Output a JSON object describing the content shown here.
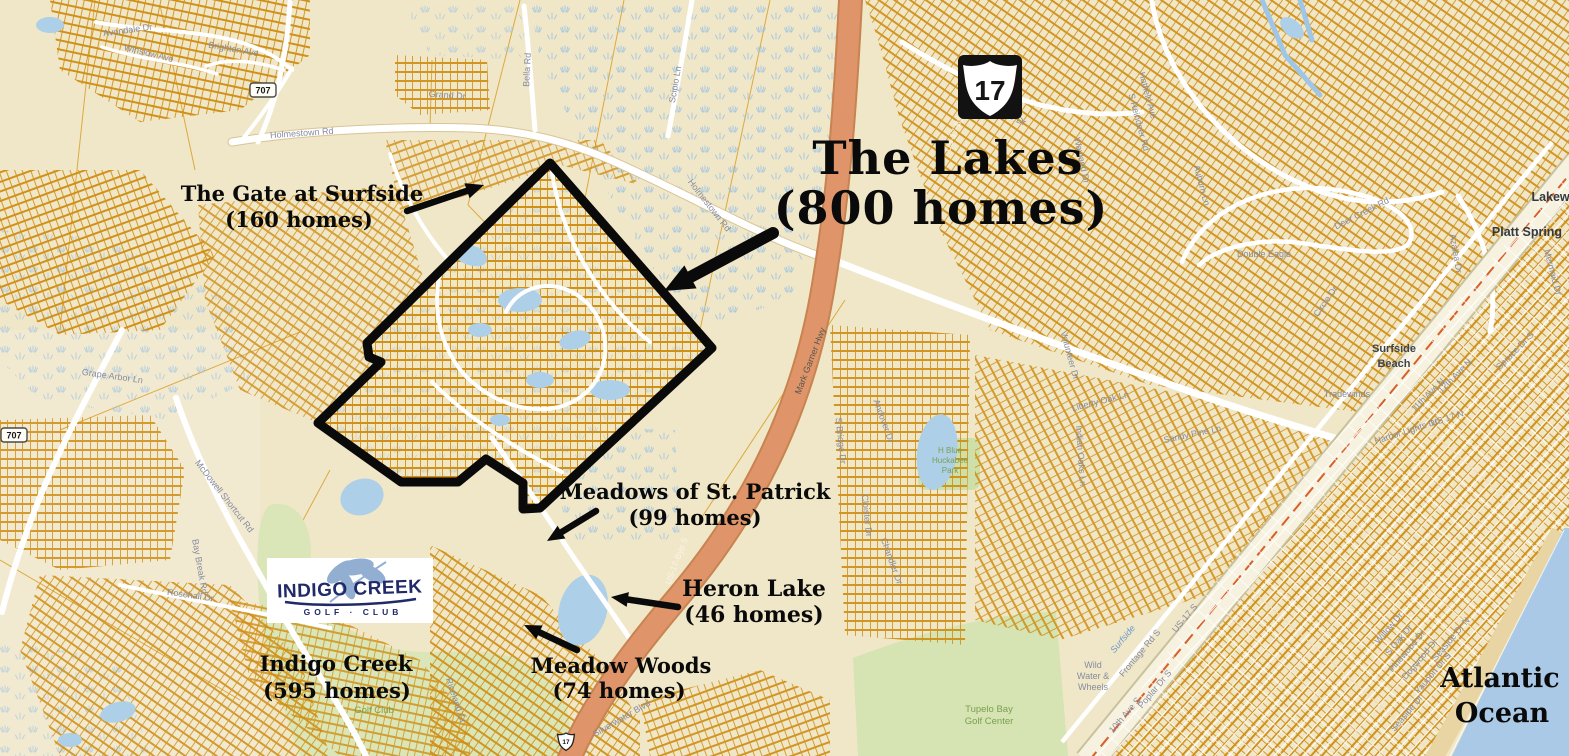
{
  "annotations": {
    "the_lakes": {
      "title": "The Lakes",
      "subtitle": "(800 homes)"
    },
    "gate": {
      "title": "The Gate at Surfside",
      "subtitle": "(160 homes)"
    },
    "meadows": {
      "title": "Meadows of St. Patrick",
      "subtitle": "(99 homes)"
    },
    "heron": {
      "title": "Heron Lake",
      "subtitle": "(46 homes)"
    },
    "meadow_woods": {
      "title": "Meadow Woods",
      "subtitle": "(74 homes)"
    },
    "indigo_creek": {
      "title": "Indigo Creek",
      "subtitle": "(595 homes)"
    },
    "ocean": {
      "line1": "Atlantic",
      "line2": "Ocean"
    }
  },
  "logo": {
    "title": "INDIGO CREEK",
    "subtitle": "GOLF · CLUB"
  },
  "shields": {
    "us17": "17",
    "small17": "17",
    "sc707": "707"
  },
  "street_labels": [
    "Avondale Dr",
    "Winslow Ave",
    "Brighton Ave",
    "Holmestown Rd",
    "Holmestown Rd",
    "Grand Dr",
    "Bella Rd",
    "Scipio Ln",
    "Sutter Dr",
    "US-17-Byp",
    "US-17-Byp S",
    "Mark Garner Hwy",
    "McDowell Shortcut Rd",
    "Bay Break Rd",
    "Rosehall Dr",
    "Grape Arbor Ln",
    "S Bridge Dr",
    "Cloister Dr",
    "Andover Dr",
    "Chandler Dr",
    "Indian Oaks Ln",
    "Liberty Oak Ln",
    "Sandy Pine Ln",
    "Volunteer Dr",
    "Hatfield Ave",
    "S Reindeer Rd",
    "Auburn Ln",
    "Wayland Dr",
    "Deer Creek Rd",
    "Circle Dr",
    "11th Ave N",
    "12th Ave N",
    "US 17 N",
    "Harbor Lights Dr",
    "Azalea Dr",
    "Spruce Dr S",
    "Mermaid Dr",
    "Frontage Rd S",
    "US-17 S",
    "Poplar Dr S",
    "10th Ave S",
    "Seaside Dr N",
    "Seaside Dr",
    "Yaupon Dr S",
    "Dogwood Dr",
    "Pinewood Dr",
    "Willow Dr",
    "S Oak Dr",
    "Silverwater Blvd",
    "Riceland Ct"
  ],
  "place_labels": [
    "Surfside",
    "Double Eagle",
    "Platt Spring",
    "Lakewood",
    "Surfside",
    "Beach",
    "Tradewinds",
    "Wild",
    "Water &",
    "Wheels",
    "Tupelo Bay",
    "Golf Center",
    "Golf Club",
    "H Blue",
    "Huckabee",
    "Park"
  ],
  "colors": {
    "land": "#f0e7c8",
    "parcel_line": "#cf8c10",
    "road": "#ffffff",
    "highway_bypass": "#df9569",
    "water": "#aecfe8",
    "marsh": "#9fc3e2",
    "golf_green": "#dbe6b8",
    "ocean": "#a9c9e6",
    "annotation": "#0a0a0a",
    "logo_navy": "#202a68",
    "logo_leaf": "#7fa1c9"
  }
}
